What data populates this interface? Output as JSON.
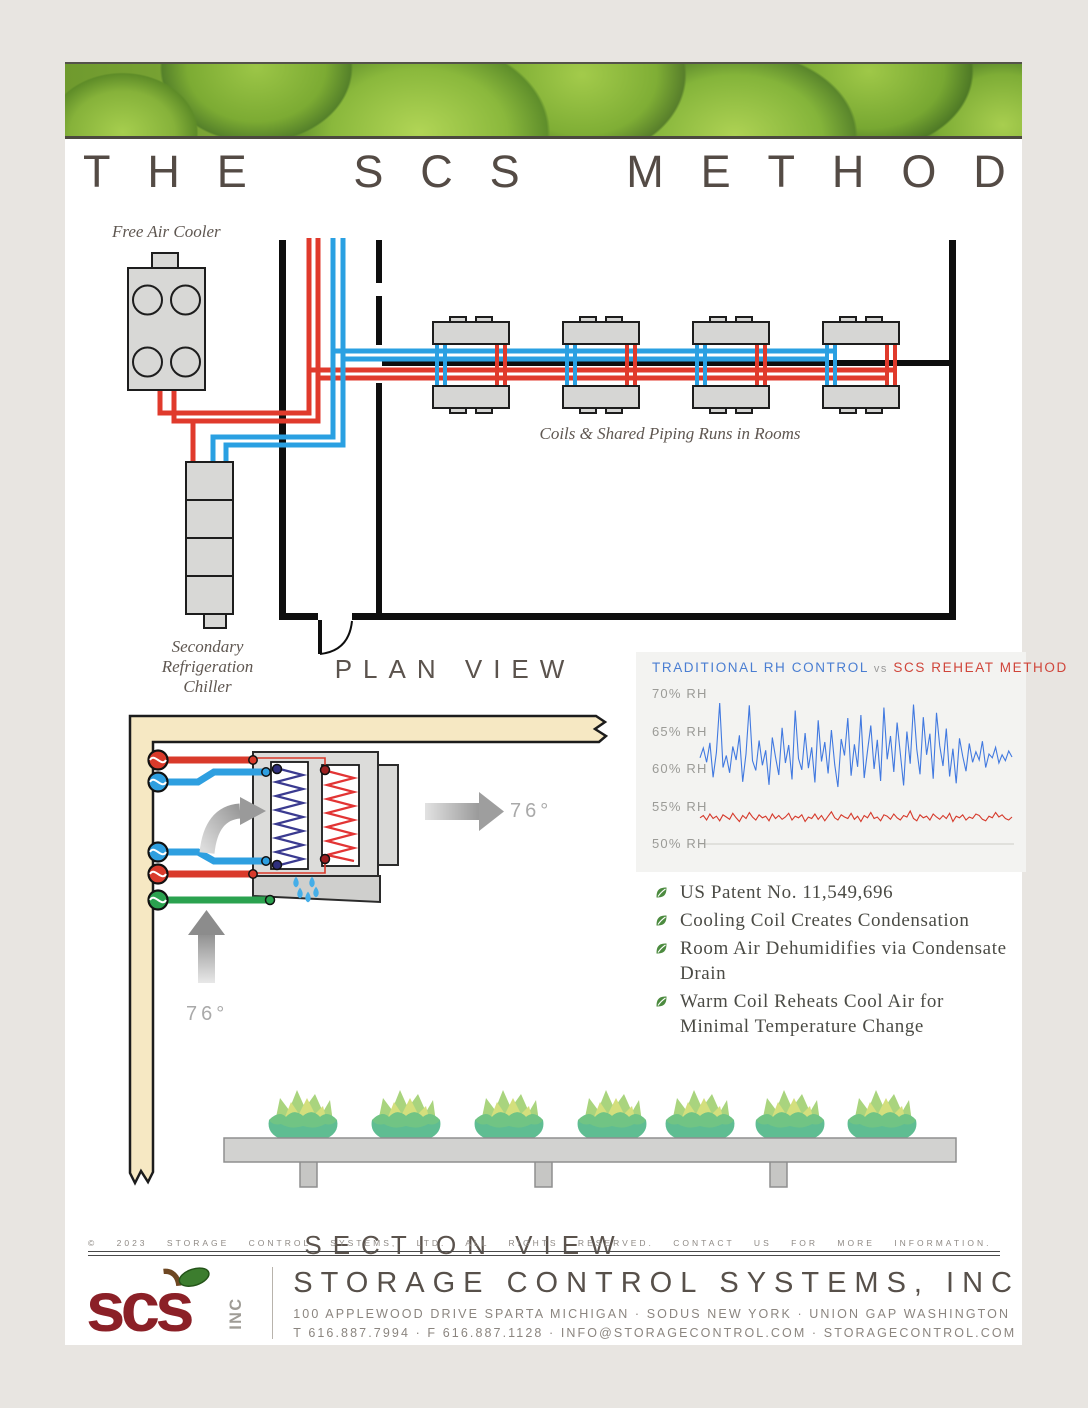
{
  "title": "THE SCS METHOD",
  "plan_view": {
    "caption": "PLAN VIEW",
    "free_air_cooler_label": "Free Air Cooler",
    "chiller_label_lines": [
      "Secondary",
      "Refrigeration",
      "Chiller"
    ],
    "coils_label": "Coils & Shared Piping Runs in Rooms"
  },
  "section_view": {
    "caption": "SECTION VIEW",
    "outlet_temp": "76°",
    "inlet_temp": "76°"
  },
  "chart_data": {
    "type": "line",
    "title": "TRADITIONAL RH CONTROL vs SCS REHEAT METHOD",
    "title_parts": {
      "left": "TRADITIONAL RH CONTROL",
      "middle": "vs",
      "right": "SCS REHEAT METHOD"
    },
    "ylabel": "% RH",
    "ylim": [
      50,
      70
    ],
    "yticks": [
      "70% RH",
      "65% RH",
      "60% RH",
      "55% RH",
      "50% RH"
    ],
    "grid": "baseline-only",
    "legend_position": "title",
    "series": [
      {
        "name": "TRADITIONAL RH CONTROL",
        "color": "#4179e0",
        "data_name": "traditional-rh-line",
        "values": [
          61.5,
          62.8,
          60.9,
          63.5,
          58.9,
          62.2,
          68.8,
          60.2,
          61.8,
          59.5,
          63.0,
          61.2,
          64.5,
          58.3,
          62.0,
          68.5,
          61.1,
          59.8,
          63.8,
          60.5,
          62.5,
          57.9,
          64.2,
          61.6,
          59.2,
          65.5,
          60.8,
          63.2,
          58.6,
          67.8,
          61.4,
          59.9,
          64.8,
          60.1,
          62.9,
          58.2,
          66.5,
          61.0,
          63.6,
          59.4,
          65.2,
          60.6,
          57.6,
          64.0,
          61.8,
          66.8,
          59.1,
          63.3,
          60.3,
          67.2,
          58.8,
          62.4,
          65.8,
          60.0,
          63.9,
          58.4,
          68.2,
          61.3,
          64.4,
          59.6,
          66.2,
          62.1,
          57.8,
          65.0,
          60.7,
          68.6,
          62.6,
          59.3,
          66.9,
          61.9,
          64.7,
          58.7,
          67.5,
          63.1,
          60.4,
          65.4,
          59.0,
          62.7,
          58.1,
          64.1,
          61.7,
          59.7,
          63.4,
          60.9,
          62.3,
          61.2,
          63.7,
          60.2,
          62.0,
          61.5,
          62.9,
          60.8,
          61.9,
          61.1,
          62.4,
          61.6
        ]
      },
      {
        "name": "SCS REHEAT METHOD",
        "color": "#d63a2c",
        "data_name": "scs-reheat-line",
        "values": [
          53.5,
          53.8,
          53.2,
          54.0,
          53.4,
          53.7,
          53.1,
          53.9,
          53.6,
          53.3,
          54.1,
          53.5,
          53.0,
          53.8,
          53.4,
          54.2,
          53.6,
          53.2,
          53.9,
          53.5,
          53.7,
          53.1,
          54.0,
          53.4,
          53.8,
          53.3,
          53.6,
          54.1,
          53.2,
          53.7,
          53.5,
          53.9,
          53.0,
          53.6,
          53.4,
          54.0,
          53.3,
          53.8,
          53.1,
          53.7,
          54.3,
          53.5,
          53.2,
          53.9,
          53.6,
          53.4,
          54.1,
          53.3,
          53.7,
          53.0,
          53.8,
          53.5,
          54.2,
          53.4,
          53.6,
          53.1,
          53.9,
          53.7,
          53.3,
          54.0,
          53.5,
          53.2,
          53.8,
          53.6,
          54.4,
          53.4,
          53.1,
          53.9,
          53.5,
          53.7,
          53.2,
          54.0,
          53.6,
          53.3,
          53.8,
          53.4,
          54.1,
          53.0,
          53.7,
          53.5,
          53.9,
          53.2,
          53.6,
          53.4,
          54.0,
          53.8,
          53.3,
          53.1,
          53.7,
          53.5,
          54.2,
          53.6,
          53.9,
          53.4,
          53.2,
          53.6
        ]
      }
    ]
  },
  "bullets": [
    "US Patent No. 11,549,696",
    "Cooling Coil Creates Condensation",
    "Room Air Dehumidifies via Condensate Drain",
    "Warm Coil Reheats Cool Air for Minimal Temperature Change"
  ],
  "footer": {
    "copyright": "© 2023 STORAGE CONTROL SYSTEMS, LTD. ALL RIGHTS RESERVED. CONTACT US FOR MORE INFORMATION.",
    "logo_text": "scs",
    "logo_suffix": "INC",
    "company": "STORAGE CONTROL SYSTEMS, INC",
    "address": "100 APPLEWOOD DRIVE SPARTA MICHIGAN · SODUS NEW YORK · UNION GAP WASHINGTON",
    "contact": "T 616.887.7994 · F 616.887.1128 · INFO@STORAGECONTROL.COM · STORAGECONTROL.COM"
  },
  "colors": {
    "pipe_hot": "#e03a2c",
    "pipe_cold": "#2aa0e2",
    "pipe_drain": "#2ba24f",
    "chart_blue": "#4179e0",
    "chart_red": "#d63a2c",
    "logo_red": "#8b2027",
    "leaf_green": "#4c8b3f",
    "wall_cream": "#f6e8c3"
  }
}
